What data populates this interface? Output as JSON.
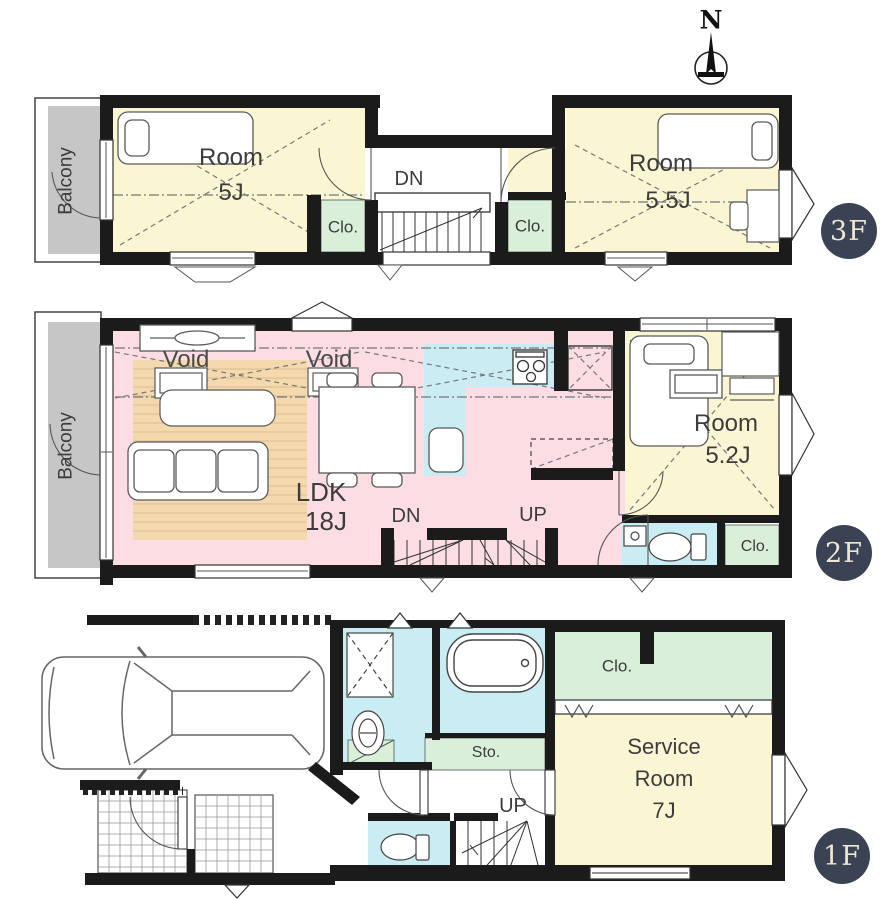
{
  "compass": {
    "north_label": "N"
  },
  "floor_3f": {
    "badge": "3F",
    "balcony_label": "Balcony",
    "room_left": {
      "name": "Room",
      "size": "5J"
    },
    "room_right": {
      "name": "Room",
      "size": "5.5J"
    },
    "closet_left": "Clo.",
    "closet_right": "Clo.",
    "stairs_down_label": "DN"
  },
  "floor_2f": {
    "badge": "2F",
    "balcony_label": "Balcony",
    "void_left": "Void",
    "void_right": "Void",
    "ldk": {
      "name": "LDK",
      "size": "18J"
    },
    "stairs_down_label": "DN",
    "stairs_up_label": "UP",
    "room": {
      "name": "Room",
      "size": "5.2J"
    },
    "closet": "Clo."
  },
  "floor_1f": {
    "badge": "1F",
    "closet": "Clo.",
    "storage": "Sto.",
    "service_room": {
      "name_line1": "Service",
      "name_line2": "Room",
      "size": "7J"
    },
    "stairs_up_label": "UP"
  },
  "colors": {
    "wall": "#1b1b1b",
    "room_yellow": "#faf6d3",
    "closet_green": "#d9efd9",
    "ldk_pink": "#fbdde3",
    "water_blue": "#c9edf3",
    "balcony_gray": "#c6c6c6",
    "wood_beige": "#f3d9ad",
    "wood_stripe": "#dcba8c",
    "badge_navy": "#3b4254",
    "badge_text": "#ede7d5",
    "label_gray": "#3c3c3c"
  }
}
